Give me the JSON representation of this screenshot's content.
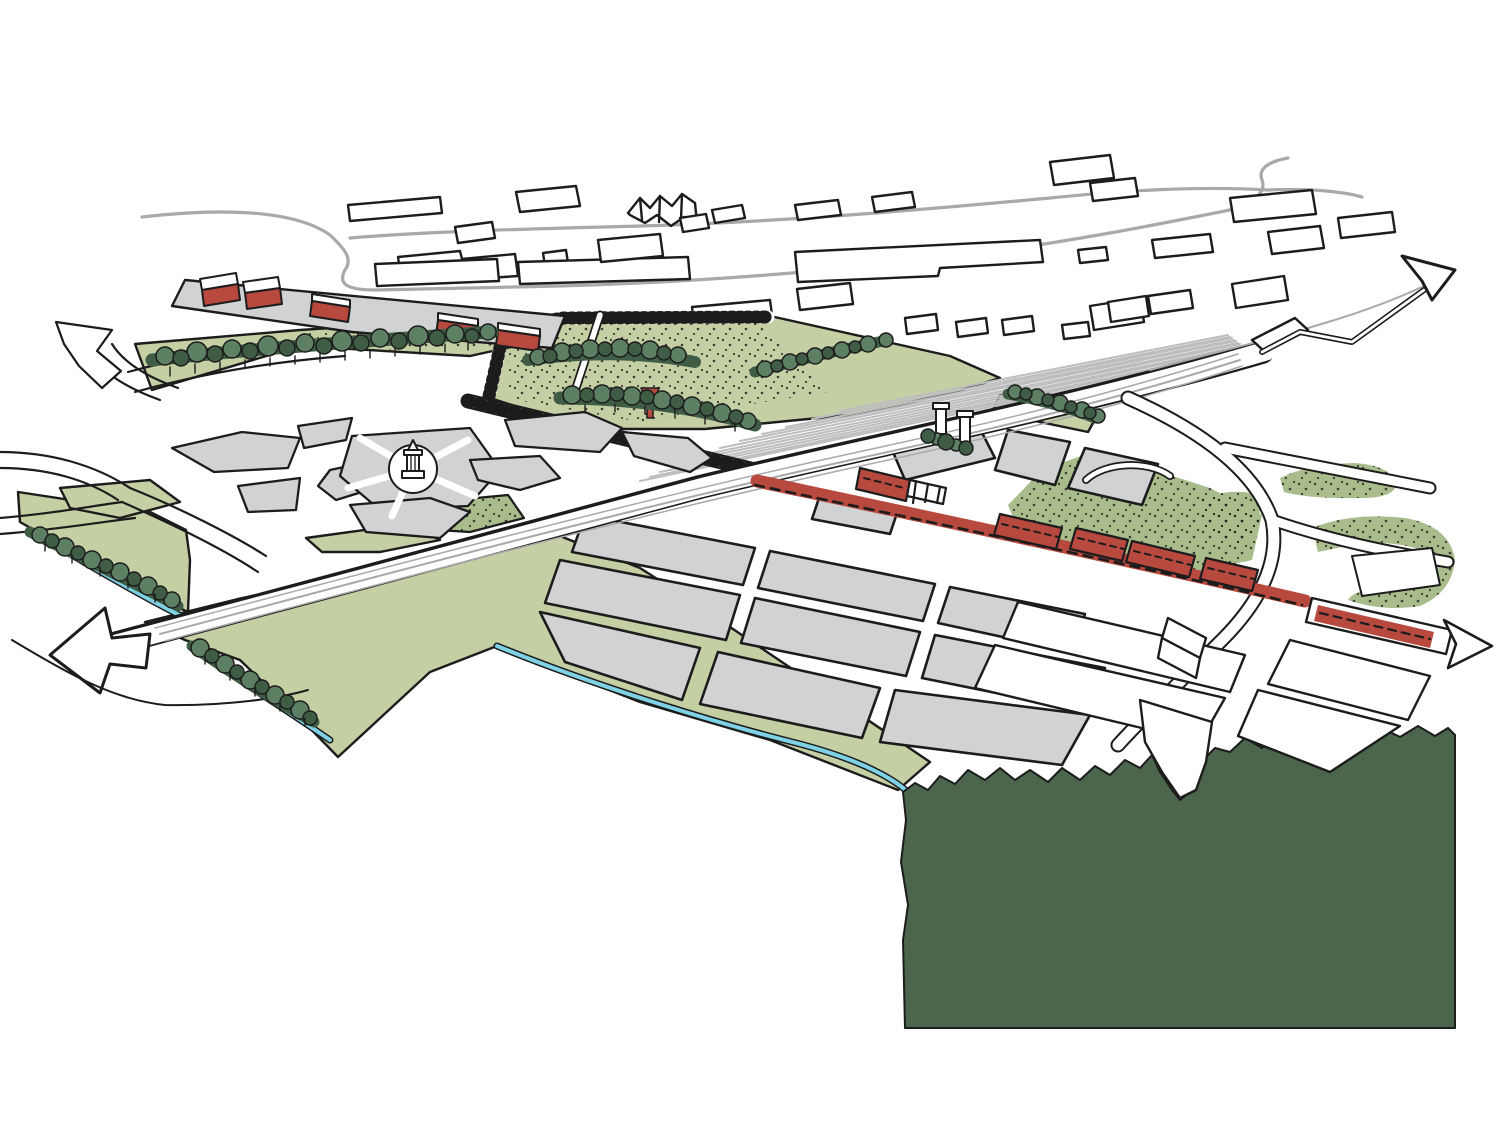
{
  "drawing": {
    "kind": "hand-drawn aerial masterplan sketch",
    "width_px": 1500,
    "height_px": 1125
  },
  "palette": {
    "paper": "#ffffff",
    "ink": "#1c1c1c",
    "block_gray": "#d0d2d3",
    "road_gray": "#a9a9a9",
    "rail_gray": "#bcbdbe",
    "meadow_green": "#c5cfa4",
    "stipple_green": "#a9bc8b",
    "tree_green_mid": "#5d7f63",
    "tree_green_dark": "#3f5c45",
    "forest_green": "#4b664d",
    "water_blue": "#7fd1e5",
    "accent_red": "#b7493f"
  },
  "features": [
    {
      "name": "existing-context-buildings",
      "style": "white footprints with ink outline"
    },
    {
      "name": "context-road",
      "style": "freehand gray line loop"
    },
    {
      "name": "railway-yard",
      "style": "fan of thin gray rails"
    },
    {
      "name": "arterial-road",
      "style": "white band with lane lines, arrows both ends"
    },
    {
      "name": "embankment-park",
      "style": "green with hatched crest and stipple"
    },
    {
      "name": "red-avenue",
      "style": "red ladder strip with funnel tower"
    },
    {
      "name": "main-street",
      "style": "red band with dashed centerline and east arrow"
    },
    {
      "name": "red-buildings",
      "style": "proposed red blocks and sheds"
    },
    {
      "name": "station-towers",
      "style": "two small towers with trees"
    },
    {
      "name": "garden-city",
      "style": "organic gray parcels around tower landmark"
    },
    {
      "name": "city-blocks",
      "style": "gray parallelogram blocks"
    },
    {
      "name": "meadow",
      "style": "light green fields with tree rows"
    },
    {
      "name": "waterline",
      "style": "cyan stream edge"
    },
    {
      "name": "forest",
      "style": "solid dark green block with ragged edge"
    }
  ],
  "arrows": [
    {
      "name": "arrow-northeast",
      "direction": "ne"
    },
    {
      "name": "arrow-northwest",
      "direction": "nw"
    },
    {
      "name": "arrow-southwest",
      "direction": "sw"
    },
    {
      "name": "arrow-east",
      "direction": "e"
    }
  ]
}
